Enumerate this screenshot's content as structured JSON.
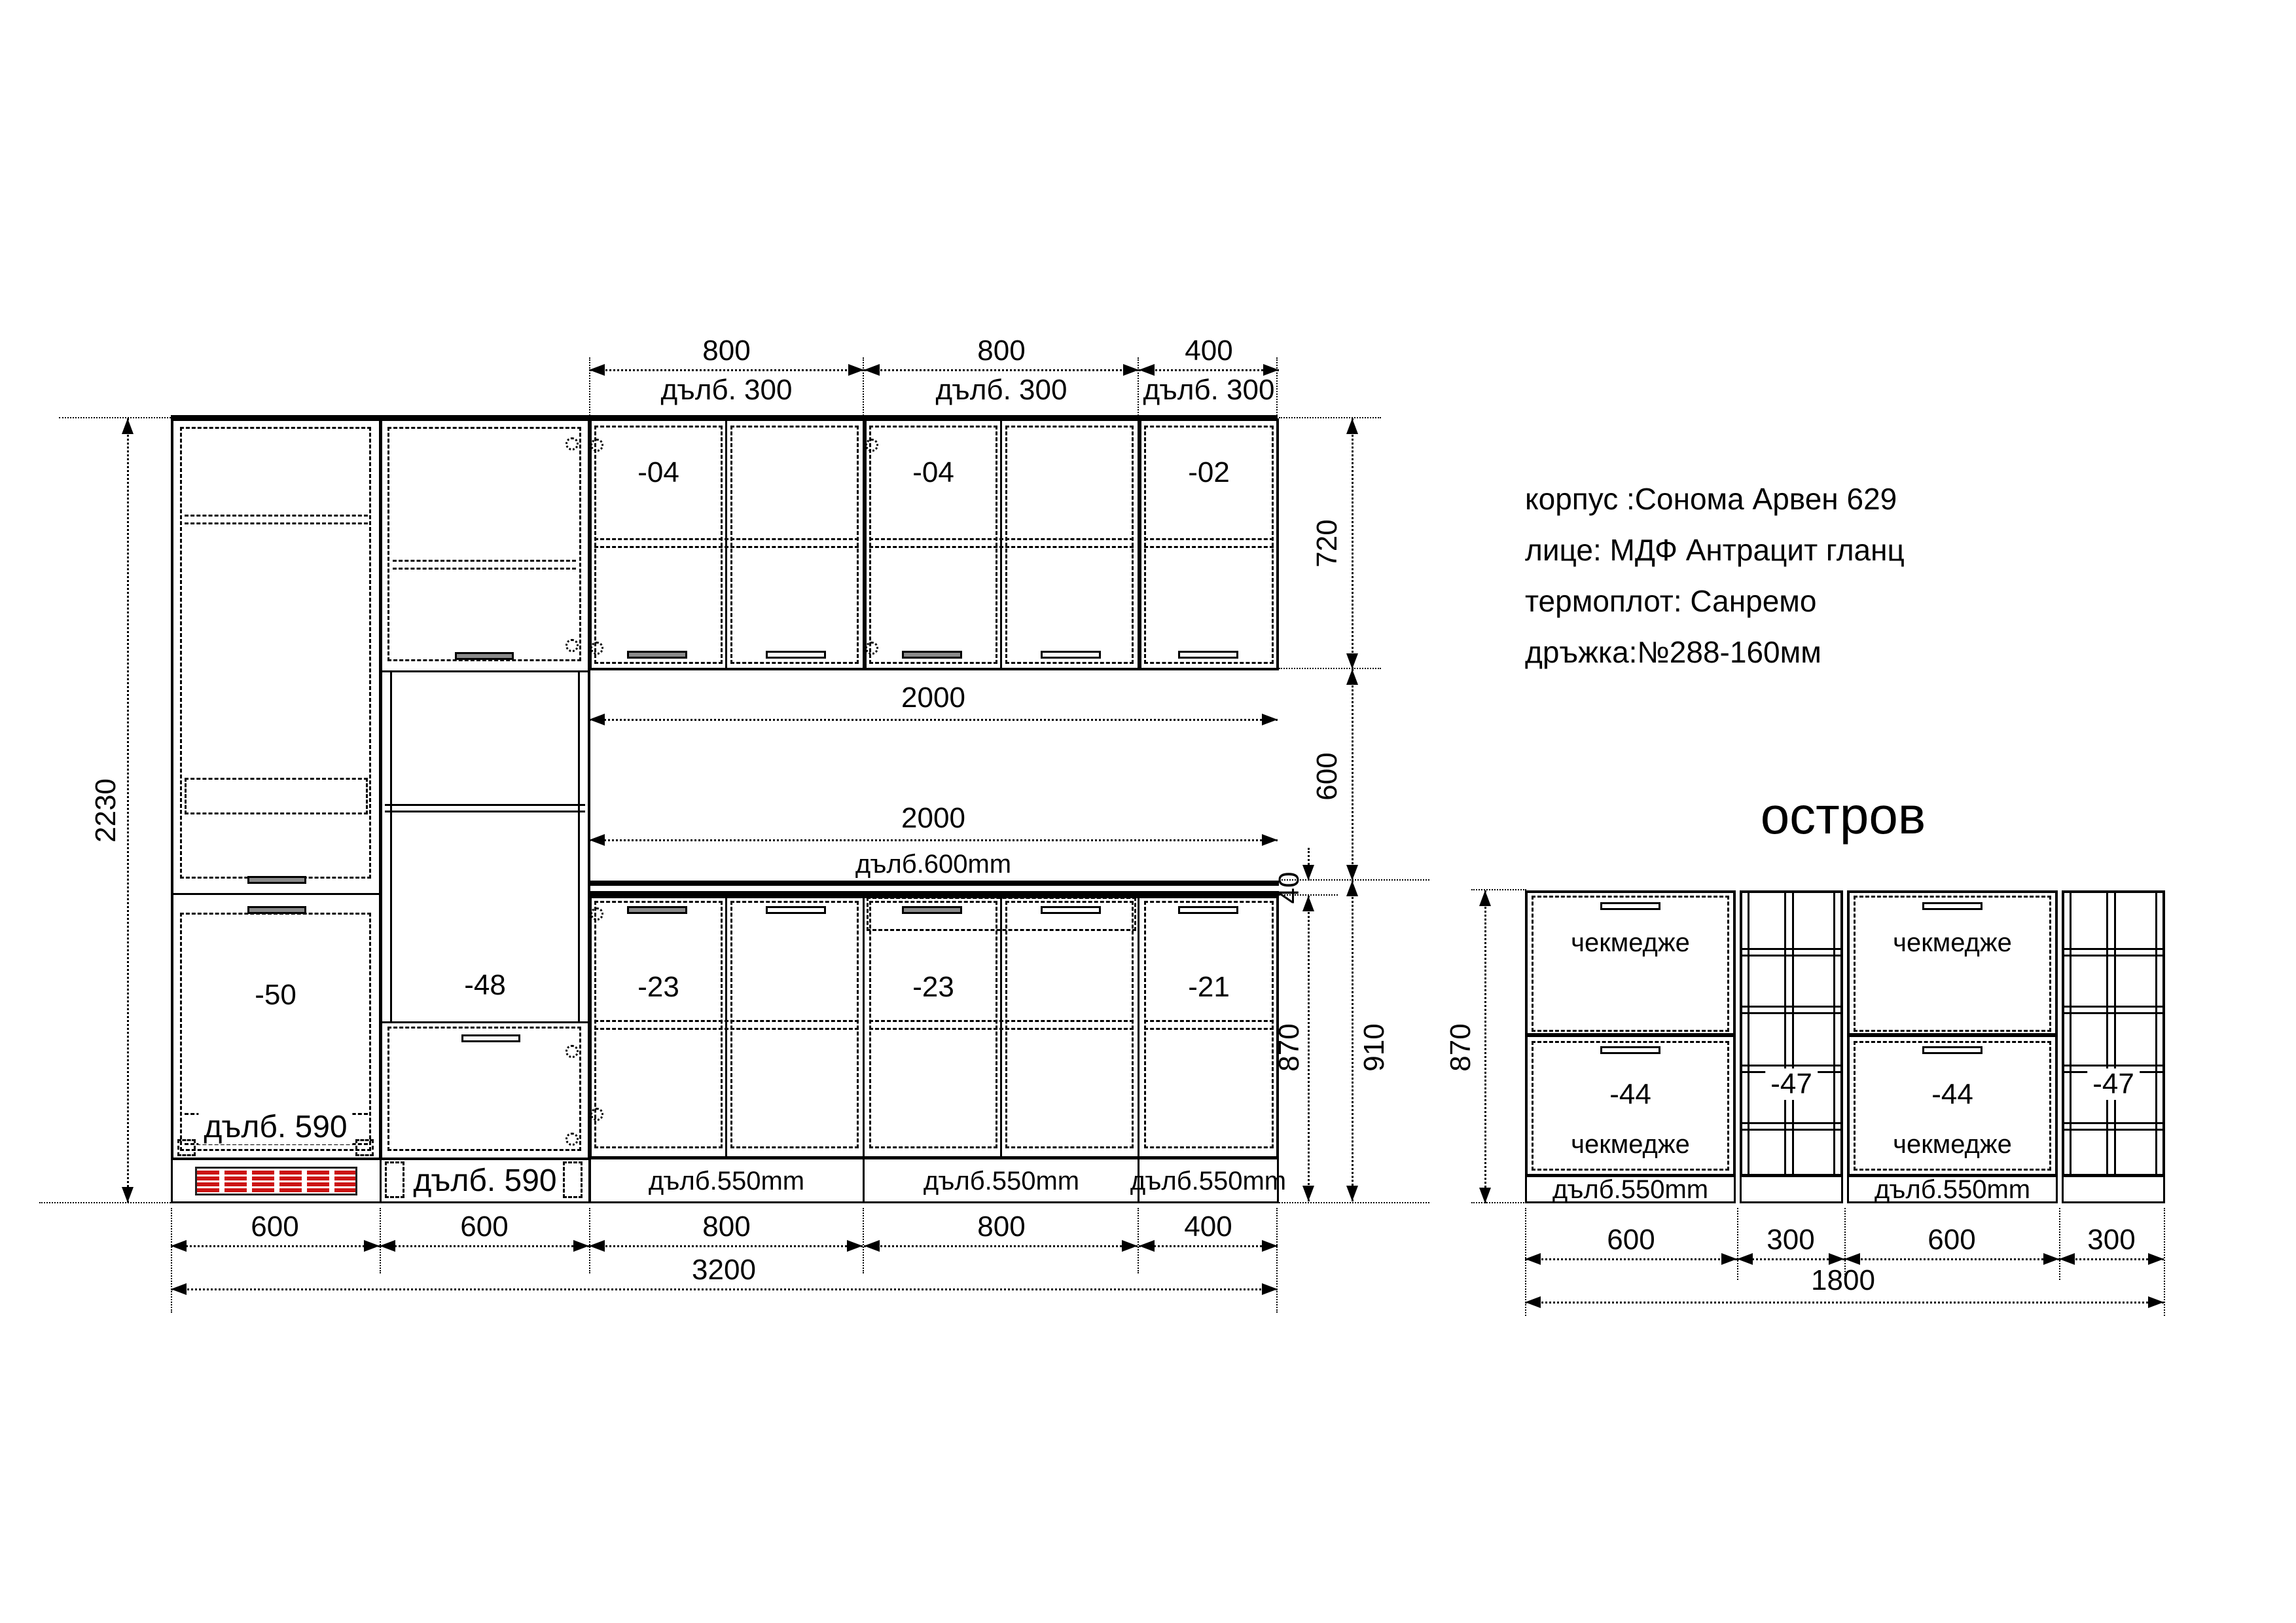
{
  "info": {
    "lines": [
      "корпус :Сонома Арвен 629",
      "лице: МДФ Антрацит гланц",
      "термоплот: Санремо",
      "дръжка:№288-160мм"
    ]
  },
  "main": {
    "top_dims": [
      {
        "w": "800",
        "d": "дълб. 300"
      },
      {
        "w": "800",
        "d": "дълб. 300"
      },
      {
        "w": "400",
        "d": "дълб. 300"
      }
    ],
    "upper_labels": [
      "-04",
      "-04",
      "-02"
    ],
    "tall_labels": [
      "-50",
      "-48"
    ],
    "tall_depths": [
      "дълб. 590",
      "дълб. 590"
    ],
    "base_labels": [
      "-23",
      "-23",
      "-21"
    ],
    "base_depths": [
      "дълб.550mm",
      "дълб.550mm",
      "дълб.550mm"
    ],
    "mid_dims": [
      "2000",
      "2000"
    ],
    "mid_depth": "дълб.600mm",
    "bottom_dims": [
      "600",
      "600",
      "800",
      "800",
      "400"
    ],
    "total_width": "3200",
    "height_dim": "2230",
    "right_dims": {
      "upper": "720",
      "splash": "600",
      "worktop_th": "40",
      "base": "870",
      "worktop": "910"
    }
  },
  "island": {
    "title": "остров",
    "height_dim": "870",
    "drawer_word": "чекмедже",
    "units": [
      {
        "label": "-44"
      },
      {
        "label": "-47"
      },
      {
        "label": "-44"
      },
      {
        "label": "-47"
      }
    ],
    "depths": [
      "дълб.550mm",
      "дълб.550mm"
    ],
    "bottom_dims": [
      "600",
      "300",
      "600",
      "300"
    ],
    "total_width": "1800"
  }
}
